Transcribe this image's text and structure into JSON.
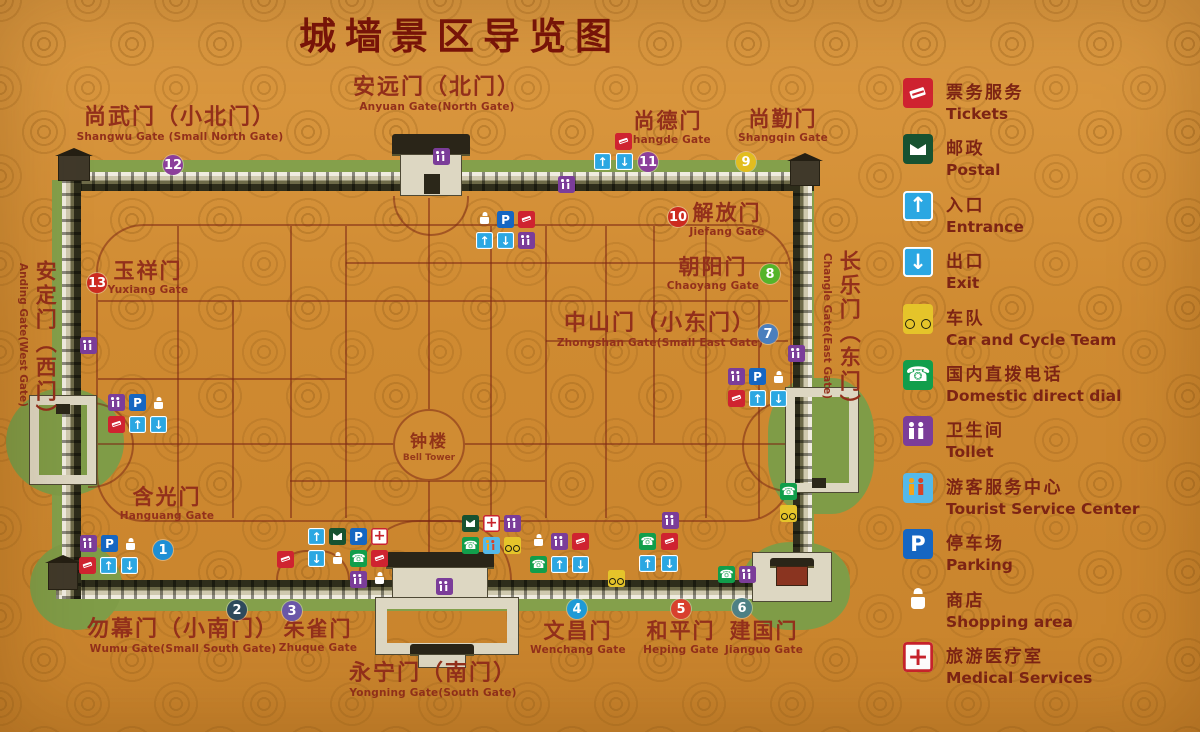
{
  "title": "城墙景区导览图",
  "legend": {
    "items": [
      {
        "icon": "tickets",
        "zh": "票务服务",
        "en": "Tickets"
      },
      {
        "icon": "postal",
        "zh": "邮政",
        "en": "Postal"
      },
      {
        "icon": "entrance",
        "zh": "入口",
        "en": "Entrance"
      },
      {
        "icon": "exit",
        "zh": "出口",
        "en": "Exit"
      },
      {
        "icon": "bike",
        "zh": "车队",
        "en": "Car and Cycle Team"
      },
      {
        "icon": "phone",
        "zh": "国内直拨电话",
        "en": "Domestic direct dial"
      },
      {
        "icon": "toilet",
        "zh": "卫生间",
        "en": "Tollet"
      },
      {
        "icon": "tourist",
        "zh": "游客服务中心",
        "en": "Tourist Service Center"
      },
      {
        "icon": "parking",
        "zh": "停车场",
        "en": "Parking"
      },
      {
        "icon": "bag",
        "zh": "商店",
        "en": "Shopping area"
      },
      {
        "icon": "medical",
        "zh": "旅游医疗室",
        "en": "Medical Services"
      }
    ]
  },
  "map": {
    "bell_tower": {
      "zh": "钟楼",
      "en": "Bell Tower"
    },
    "gates": [
      {
        "id": "anyuan",
        "zh": "安远门（北门）",
        "en": "Anyuan Gate(North Gate)",
        "x": 437,
        "y": 76,
        "dir": "h",
        "size": "lg"
      },
      {
        "id": "shangwu",
        "zh": "尚武门（小北门）",
        "en": "Shangwu Gate (Small North Gate)",
        "x": 180,
        "y": 106,
        "dir": "h",
        "size": "lg"
      },
      {
        "id": "shangde",
        "zh": "尚德门",
        "en": "Shangde Gate",
        "x": 668,
        "y": 110,
        "dir": "h",
        "size": "md"
      },
      {
        "id": "shangqin",
        "zh": "尚勤门",
        "en": "Shangqin Gate",
        "x": 783,
        "y": 108,
        "dir": "h",
        "size": "md"
      },
      {
        "id": "jiefang",
        "zh": "解放门",
        "en": "Jiefang Gate",
        "x": 727,
        "y": 202,
        "dir": "h",
        "size": "md"
      },
      {
        "id": "chaoyang",
        "zh": "朝阳门",
        "en": "Chaoyang Gate",
        "x": 713,
        "y": 256,
        "dir": "h",
        "size": "md"
      },
      {
        "id": "zhongshan",
        "zh": "中山门（小东门）",
        "en": "Zhongshan Gate(Small East Gate)",
        "x": 660,
        "y": 312,
        "dir": "h",
        "size": "lg"
      },
      {
        "id": "changle",
        "zh": "长乐门（东门）",
        "en": "Changle Gate(East  Gate)",
        "x": 820,
        "y": 250,
        "dir": "v",
        "size": "lg"
      },
      {
        "id": "anding",
        "zh": "安定门（西门）",
        "en": "Anding Gate(West Gate)",
        "x": 16,
        "y": 260,
        "dir": "v",
        "size": "lg"
      },
      {
        "id": "yuxiang",
        "zh": "玉祥门",
        "en": "Yuxiang Gate",
        "x": 148,
        "y": 260,
        "dir": "h",
        "size": "md"
      },
      {
        "id": "hanguang",
        "zh": "含光门",
        "en": "Hanguang Gate",
        "x": 167,
        "y": 486,
        "dir": "h",
        "size": "md"
      },
      {
        "id": "wumu",
        "zh": "勿幕门（小南门）",
        "en": "Wumu Gate(Small South Gate)",
        "x": 183,
        "y": 618,
        "dir": "h",
        "size": "lg"
      },
      {
        "id": "zhuque",
        "zh": "朱雀门",
        "en": "Zhuque Gate",
        "x": 318,
        "y": 618,
        "dir": "h",
        "size": "md"
      },
      {
        "id": "yongning",
        "zh": "永宁门（南门）",
        "en": "Yongning Gate(South Gate)",
        "x": 433,
        "y": 662,
        "dir": "h",
        "size": "lg"
      },
      {
        "id": "wenchang",
        "zh": "文昌门",
        "en": "Wenchang Gate",
        "x": 578,
        "y": 620,
        "dir": "h",
        "size": "md"
      },
      {
        "id": "heping",
        "zh": "和平门",
        "en": "Heping Gate",
        "x": 681,
        "y": 620,
        "dir": "h",
        "size": "md"
      },
      {
        "id": "jianguo",
        "zh": "建国门",
        "en": "Jianguo Gate",
        "x": 764,
        "y": 620,
        "dir": "h",
        "size": "md"
      }
    ],
    "markers": [
      {
        "n": "1",
        "x": 163,
        "y": 550,
        "color": "#1e8fd5"
      },
      {
        "n": "2",
        "x": 237,
        "y": 610,
        "color": "#2e4a5c"
      },
      {
        "n": "3",
        "x": 292,
        "y": 611,
        "color": "#6a57a8"
      },
      {
        "n": "4",
        "x": 577,
        "y": 609,
        "color": "#1e9ad6"
      },
      {
        "n": "5",
        "x": 681,
        "y": 609,
        "color": "#d8402e"
      },
      {
        "n": "6",
        "x": 742,
        "y": 608,
        "color": "#4e8084"
      },
      {
        "n": "7",
        "x": 768,
        "y": 334,
        "color": "#4a7fbd"
      },
      {
        "n": "8",
        "x": 770,
        "y": 274,
        "color": "#54b42a"
      },
      {
        "n": "9",
        "x": 746,
        "y": 162,
        "color": "#e2bd1f"
      },
      {
        "n": "10",
        "x": 678,
        "y": 217,
        "color": "#cc2a20"
      },
      {
        "n": "11",
        "x": 648,
        "y": 162,
        "color": "#8c3f9b"
      },
      {
        "n": "12",
        "x": 173,
        "y": 165,
        "color": "#8c3f9b"
      },
      {
        "n": "13",
        "x": 97,
        "y": 283,
        "color": "#cc2a20"
      }
    ],
    "icons": [
      {
        "t": "toilet",
        "x": 433,
        "y": 148
      },
      {
        "t": "toilet",
        "x": 558,
        "y": 176
      },
      {
        "t": "toilet",
        "x": 80,
        "y": 337
      },
      {
        "t": "toilet",
        "x": 788,
        "y": 345
      },
      {
        "t": "toilet",
        "x": 436,
        "y": 578
      },
      {
        "t": "bag",
        "x": 476,
        "y": 211
      },
      {
        "t": "parking",
        "x": 497,
        "y": 211
      },
      {
        "t": "tickets",
        "x": 518,
        "y": 211
      },
      {
        "t": "entrance",
        "x": 476,
        "y": 232
      },
      {
        "t": "exit",
        "x": 497,
        "y": 232
      },
      {
        "t": "toilet",
        "x": 518,
        "y": 232
      },
      {
        "t": "tickets",
        "x": 615,
        "y": 133
      },
      {
        "t": "entrance",
        "x": 594,
        "y": 153
      },
      {
        "t": "exit",
        "x": 616,
        "y": 153
      },
      {
        "t": "toilet",
        "x": 108,
        "y": 394
      },
      {
        "t": "parking",
        "x": 129,
        "y": 394
      },
      {
        "t": "bag",
        "x": 150,
        "y": 396
      },
      {
        "t": "tickets",
        "x": 108,
        "y": 416
      },
      {
        "t": "entrance",
        "x": 129,
        "y": 416
      },
      {
        "t": "exit",
        "x": 150,
        "y": 416
      },
      {
        "t": "toilet",
        "x": 80,
        "y": 535
      },
      {
        "t": "parking",
        "x": 101,
        "y": 535
      },
      {
        "t": "bag",
        "x": 122,
        "y": 537
      },
      {
        "t": "tickets",
        "x": 79,
        "y": 557
      },
      {
        "t": "entrance",
        "x": 100,
        "y": 557
      },
      {
        "t": "exit",
        "x": 121,
        "y": 557
      },
      {
        "t": "entrance",
        "x": 308,
        "y": 528
      },
      {
        "t": "postal",
        "x": 329,
        "y": 528
      },
      {
        "t": "parking",
        "x": 350,
        "y": 528
      },
      {
        "t": "medical",
        "x": 371,
        "y": 528
      },
      {
        "t": "tickets",
        "x": 277,
        "y": 551
      },
      {
        "t": "exit",
        "x": 308,
        "y": 550
      },
      {
        "t": "bag",
        "x": 329,
        "y": 551
      },
      {
        "t": "phone",
        "x": 350,
        "y": 550
      },
      {
        "t": "tickets",
        "x": 371,
        "y": 550
      },
      {
        "t": "toilet",
        "x": 350,
        "y": 571
      },
      {
        "t": "bag",
        "x": 371,
        "y": 571
      },
      {
        "t": "postal",
        "x": 462,
        "y": 515
      },
      {
        "t": "medical",
        "x": 483,
        "y": 515
      },
      {
        "t": "toilet",
        "x": 504,
        "y": 515
      },
      {
        "t": "phone",
        "x": 462,
        "y": 537
      },
      {
        "t": "tourist",
        "x": 483,
        "y": 537
      },
      {
        "t": "bike",
        "x": 504,
        "y": 537
      },
      {
        "t": "bag",
        "x": 530,
        "y": 533
      },
      {
        "t": "toilet",
        "x": 551,
        "y": 533
      },
      {
        "t": "tickets",
        "x": 572,
        "y": 533
      },
      {
        "t": "phone",
        "x": 530,
        "y": 556
      },
      {
        "t": "entrance",
        "x": 551,
        "y": 556
      },
      {
        "t": "exit",
        "x": 572,
        "y": 556
      },
      {
        "t": "toilet",
        "x": 662,
        "y": 512
      },
      {
        "t": "phone",
        "x": 639,
        "y": 533
      },
      {
        "t": "tickets",
        "x": 661,
        "y": 533
      },
      {
        "t": "entrance",
        "x": 639,
        "y": 555
      },
      {
        "t": "exit",
        "x": 661,
        "y": 555
      },
      {
        "t": "bike",
        "x": 608,
        "y": 570
      },
      {
        "t": "phone",
        "x": 718,
        "y": 566
      },
      {
        "t": "toilet",
        "x": 739,
        "y": 566
      },
      {
        "t": "toilet",
        "x": 728,
        "y": 368
      },
      {
        "t": "parking",
        "x": 749,
        "y": 368
      },
      {
        "t": "bag",
        "x": 770,
        "y": 370
      },
      {
        "t": "tickets",
        "x": 728,
        "y": 390
      },
      {
        "t": "entrance",
        "x": 749,
        "y": 390
      },
      {
        "t": "exit",
        "x": 770,
        "y": 390
      },
      {
        "t": "phone",
        "x": 780,
        "y": 483
      },
      {
        "t": "bike",
        "x": 780,
        "y": 505
      }
    ]
  }
}
